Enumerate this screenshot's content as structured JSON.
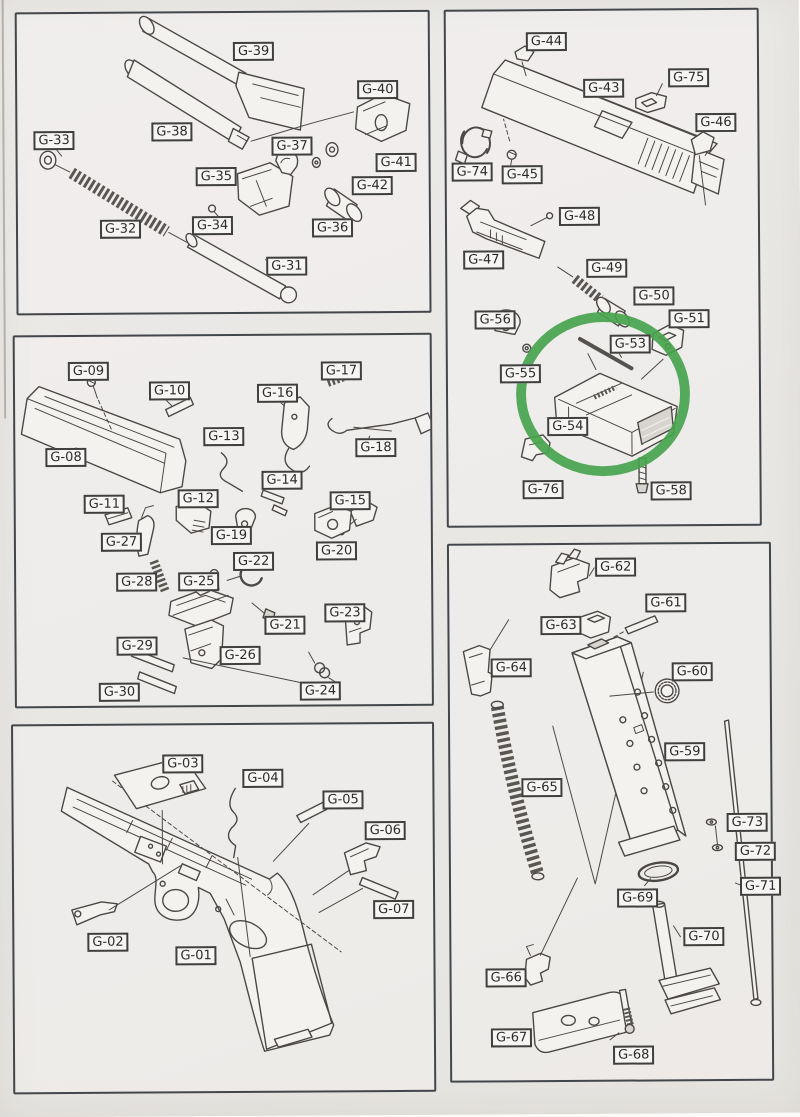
{
  "document": {
    "kind": "exploded parts diagram (scanned page)",
    "ink_color": "#4b4744",
    "paper_color": "#e9e7e4",
    "label_border_color": "#3f3f3d",
    "panel_border_color": "#43464b"
  },
  "highlight": {
    "highlighted_part": "G-54",
    "color": "#46a44d",
    "panel": "slide-internals-group",
    "cx": 157,
    "cy": 387,
    "rx": 83,
    "ry": 78,
    "stroke_width": 10
  },
  "panels": [
    {
      "key": "p1",
      "name": "barrel-recoil-group",
      "x": 22,
      "y": 14,
      "w": 415,
      "h": 303,
      "parts": [
        {
          "label": "G-39",
          "x": 216,
          "y": 29
        },
        {
          "label": "G-40",
          "x": 340,
          "y": 68
        },
        {
          "label": "G-38",
          "x": 134,
          "y": 109
        },
        {
          "label": "G-37",
          "x": 254,
          "y": 124
        },
        {
          "label": "G-33",
          "x": 16,
          "y": 117
        },
        {
          "label": "G-41",
          "x": 358,
          "y": 141
        },
        {
          "label": "G-35",
          "x": 178,
          "y": 154
        },
        {
          "label": "G-42",
          "x": 334,
          "y": 164
        },
        {
          "label": "G-34",
          "x": 174,
          "y": 203
        },
        {
          "label": "G-32",
          "x": 82,
          "y": 206
        },
        {
          "label": "G-36",
          "x": 294,
          "y": 206
        },
        {
          "label": "G-31",
          "x": 248,
          "y": 244
        }
      ]
    },
    {
      "key": "p2",
      "name": "trigger-receiver-group",
      "x": 18,
      "y": 337,
      "w": 419,
      "h": 373,
      "parts": [
        {
          "label": "G-09",
          "x": 53,
          "y": 25
        },
        {
          "label": "G-17",
          "x": 306,
          "y": 26
        },
        {
          "label": "G-10",
          "x": 134,
          "y": 45
        },
        {
          "label": "G-16",
          "x": 242,
          "y": 48
        },
        {
          "label": "G-13",
          "x": 188,
          "y": 91
        },
        {
          "label": "G-18",
          "x": 340,
          "y": 103
        },
        {
          "label": "G-08",
          "x": 30,
          "y": 111
        },
        {
          "label": "G-14",
          "x": 246,
          "y": 135
        },
        {
          "label": "G-12",
          "x": 162,
          "y": 153
        },
        {
          "label": "G-15",
          "x": 314,
          "y": 156
        },
        {
          "label": "G-11",
          "x": 68,
          "y": 158
        },
        {
          "label": "G-19",
          "x": 195,
          "y": 190
        },
        {
          "label": "G-27",
          "x": 85,
          "y": 196
        },
        {
          "label": "G-20",
          "x": 300,
          "y": 206
        },
        {
          "label": "G-22",
          "x": 217,
          "y": 216
        },
        {
          "label": "G-28",
          "x": 100,
          "y": 236
        },
        {
          "label": "G-25",
          "x": 162,
          "y": 236
        },
        {
          "label": "G-23",
          "x": 308,
          "y": 268
        },
        {
          "label": "G-21",
          "x": 248,
          "y": 280
        },
        {
          "label": "G-29",
          "x": 100,
          "y": 300
        },
        {
          "label": "G-26",
          "x": 203,
          "y": 310
        },
        {
          "label": "G-30",
          "x": 82,
          "y": 346
        },
        {
          "label": "G-24",
          "x": 283,
          "y": 346
        }
      ]
    },
    {
      "key": "p3",
      "name": "frame-group",
      "x": 14,
      "y": 726,
      "w": 423,
      "h": 370,
      "parts": [
        {
          "label": "G-03",
          "x": 149,
          "y": 29
        },
        {
          "label": "G-04",
          "x": 229,
          "y": 44
        },
        {
          "label": "G-05",
          "x": 309,
          "y": 66
        },
        {
          "label": "G-06",
          "x": 351,
          "y": 97
        },
        {
          "label": "G-07",
          "x": 359,
          "y": 176
        },
        {
          "label": "G-02",
          "x": 73,
          "y": 207
        },
        {
          "label": "G-01",
          "x": 161,
          "y": 221
        }
      ]
    },
    {
      "key": "p4",
      "name": "slide-internals-group",
      "x": 451,
      "y": 14,
      "w": 315,
      "h": 518,
      "parts": [
        {
          "label": "G-44",
          "x": 80,
          "y": 21
        },
        {
          "label": "G-75",
          "x": 222,
          "y": 58
        },
        {
          "label": "G-43",
          "x": 137,
          "y": 68
        },
        {
          "label": "G-46",
          "x": 249,
          "y": 103
        },
        {
          "label": "G-74",
          "x": 5,
          "y": 151
        },
        {
          "label": "G-45",
          "x": 55,
          "y": 154
        },
        {
          "label": "G-48",
          "x": 112,
          "y": 196
        },
        {
          "label": "G-47",
          "x": 16,
          "y": 239
        },
        {
          "label": "G-49",
          "x": 139,
          "y": 248
        },
        {
          "label": "G-50",
          "x": 186,
          "y": 276
        },
        {
          "label": "G-56",
          "x": 27,
          "y": 299
        },
        {
          "label": "G-51",
          "x": 221,
          "y": 299
        },
        {
          "label": "G-53",
          "x": 162,
          "y": 324
        },
        {
          "label": "G-55",
          "x": 52,
          "y": 353
        },
        {
          "label": "G-54",
          "x": 99,
          "y": 406
        },
        {
          "label": "G-76",
          "x": 74,
          "y": 469
        },
        {
          "label": "G-58",
          "x": 202,
          "y": 471
        }
      ]
    },
    {
      "key": "p5",
      "name": "magazine-group",
      "x": 451,
      "y": 548,
      "w": 324,
      "h": 539,
      "parts": [
        {
          "label": "G-62",
          "x": 146,
          "y": 13
        },
        {
          "label": "G-61",
          "x": 196,
          "y": 49
        },
        {
          "label": "G-63",
          "x": 91,
          "y": 71
        },
        {
          "label": "G-64",
          "x": 41,
          "y": 113
        },
        {
          "label": "G-60",
          "x": 222,
          "y": 118
        },
        {
          "label": "G-59",
          "x": 214,
          "y": 198
        },
        {
          "label": "G-65",
          "x": 71,
          "y": 233
        },
        {
          "label": "G-73",
          "x": 276,
          "y": 269
        },
        {
          "label": "G-72",
          "x": 284,
          "y": 298
        },
        {
          "label": "G-71",
          "x": 289,
          "y": 333
        },
        {
          "label": "G-69",
          "x": 166,
          "y": 344
        },
        {
          "label": "G-70",
          "x": 232,
          "y": 383
        },
        {
          "label": "G-66",
          "x": 34,
          "y": 423
        },
        {
          "label": "G-67",
          "x": 39,
          "y": 483
        },
        {
          "label": "G-68",
          "x": 161,
          "y": 501
        }
      ]
    }
  ]
}
